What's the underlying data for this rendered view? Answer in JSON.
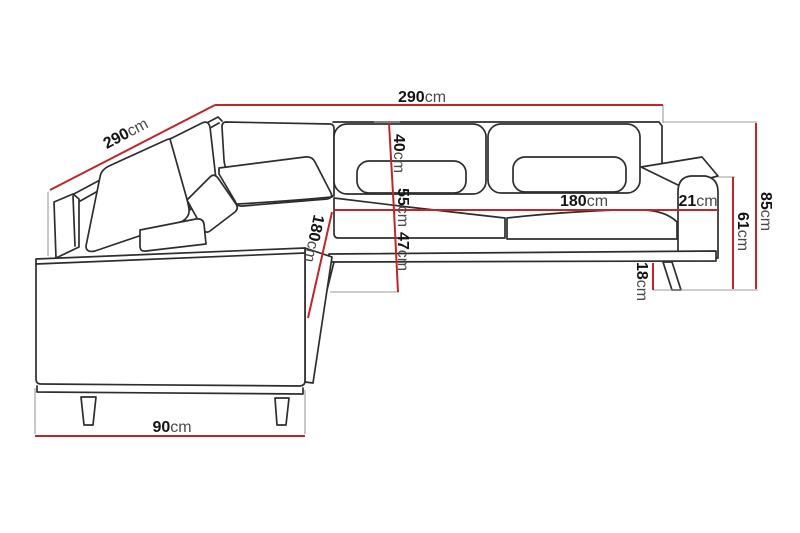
{
  "diagram": {
    "title": "Corner sofa dimension diagram",
    "unit": "cm",
    "colors": {
      "dimension_line": "#bf2629",
      "outline": "#2e2e2e",
      "extension_line": "#9b9b9b",
      "background": "#ffffff"
    },
    "dimensions": [
      {
        "id": "top-width",
        "value": "290",
        "unit": "cm"
      },
      {
        "id": "left-depth",
        "value": "290",
        "unit": "cm"
      },
      {
        "id": "backrest-height",
        "value": "40",
        "unit": "cm"
      },
      {
        "id": "seat-height-cushion",
        "value": "55",
        "unit": "cm"
      },
      {
        "id": "seat-height",
        "value": "47",
        "unit": "cm"
      },
      {
        "id": "seat-width",
        "value": "180",
        "unit": "cm"
      },
      {
        "id": "armrest-width",
        "value": "21",
        "unit": "cm"
      },
      {
        "id": "total-height",
        "value": "85",
        "unit": "cm"
      },
      {
        "id": "armrest-height",
        "value": "61",
        "unit": "cm"
      },
      {
        "id": "leg-height",
        "value": "18",
        "unit": "cm"
      },
      {
        "id": "chaise-length",
        "value": "180",
        "unit": "cm"
      },
      {
        "id": "base-front-width",
        "value": "90",
        "unit": "cm"
      }
    ]
  }
}
